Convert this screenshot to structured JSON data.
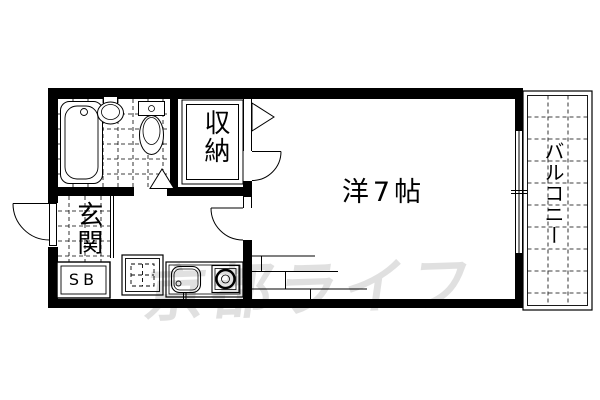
{
  "plan": {
    "room_label": "洋7帖",
    "closet_label": "収納",
    "entrance_label": "玄関",
    "shoe_box_label": "SB",
    "balcony_label": "バルコニー"
  },
  "watermark": {
    "text": "京都ライフ"
  },
  "colors": {
    "lines": "#000000",
    "background": "#ffffff",
    "watermark_gray": "#e3e3e3"
  },
  "fixtures": [
    "bathtub",
    "wash-basin",
    "toilet",
    "bathroom-folding-door",
    "closet-folding-door",
    "room-door",
    "corridor-door",
    "entrance-door",
    "kitchen-sink",
    "gas-stove",
    "washing-machine-space",
    "shoe-box",
    "loft-stairs",
    "balcony-window",
    "tile-floor"
  ]
}
